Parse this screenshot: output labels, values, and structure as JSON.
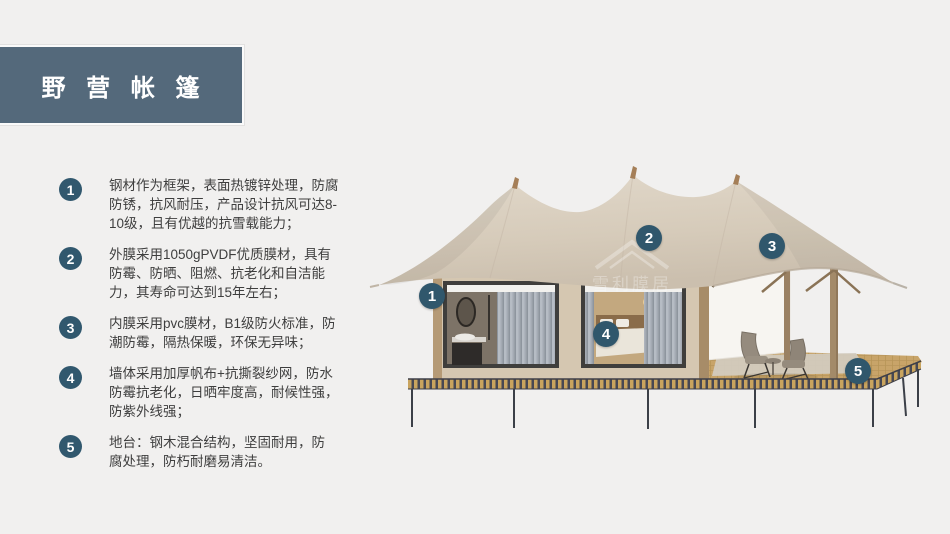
{
  "slide": {
    "title": "野  营  帐  篷",
    "background_color": "#f1f0ef",
    "title_bar_color": "#54697b",
    "badge_color": "#31586e"
  },
  "features": [
    {
      "num": "1",
      "lines": [
        "钢材作为框架，表面热镀锌处理，防腐",
        "防锈，抗风耐压，产品设计抗风可达8-",
        "10级，且有优越的抗雪载能力；"
      ]
    },
    {
      "num": "2",
      "lines": [
        "外膜采用1050gPVDF优质膜材，具有",
        "防霉、防晒、阻燃、抗老化和自洁能",
        "力，其寿命可达到15年左右；"
      ]
    },
    {
      "num": "3",
      "lines": [
        "内膜采用pvc膜材，B1级防火标准，防",
        "潮防霉，隔热保暖，环保无异味；"
      ]
    },
    {
      "num": "4",
      "lines": [
        "墙体采用加厚帆布+抗撕裂纱网，防水",
        "防霉抗老化，日晒牢度高，耐候性强，",
        "防紫外线强；"
      ]
    },
    {
      "num": "5",
      "lines": [
        "地台：钢木混合结构，坚固耐用，防",
        "腐处理，防朽耐磨易清洁。"
      ]
    }
  ],
  "diagram": {
    "watermark": "雪利膜居",
    "callouts": [
      {
        "label": "1"
      },
      {
        "label": "2"
      },
      {
        "label": "3"
      },
      {
        "label": "4"
      },
      {
        "label": "5"
      }
    ]
  }
}
